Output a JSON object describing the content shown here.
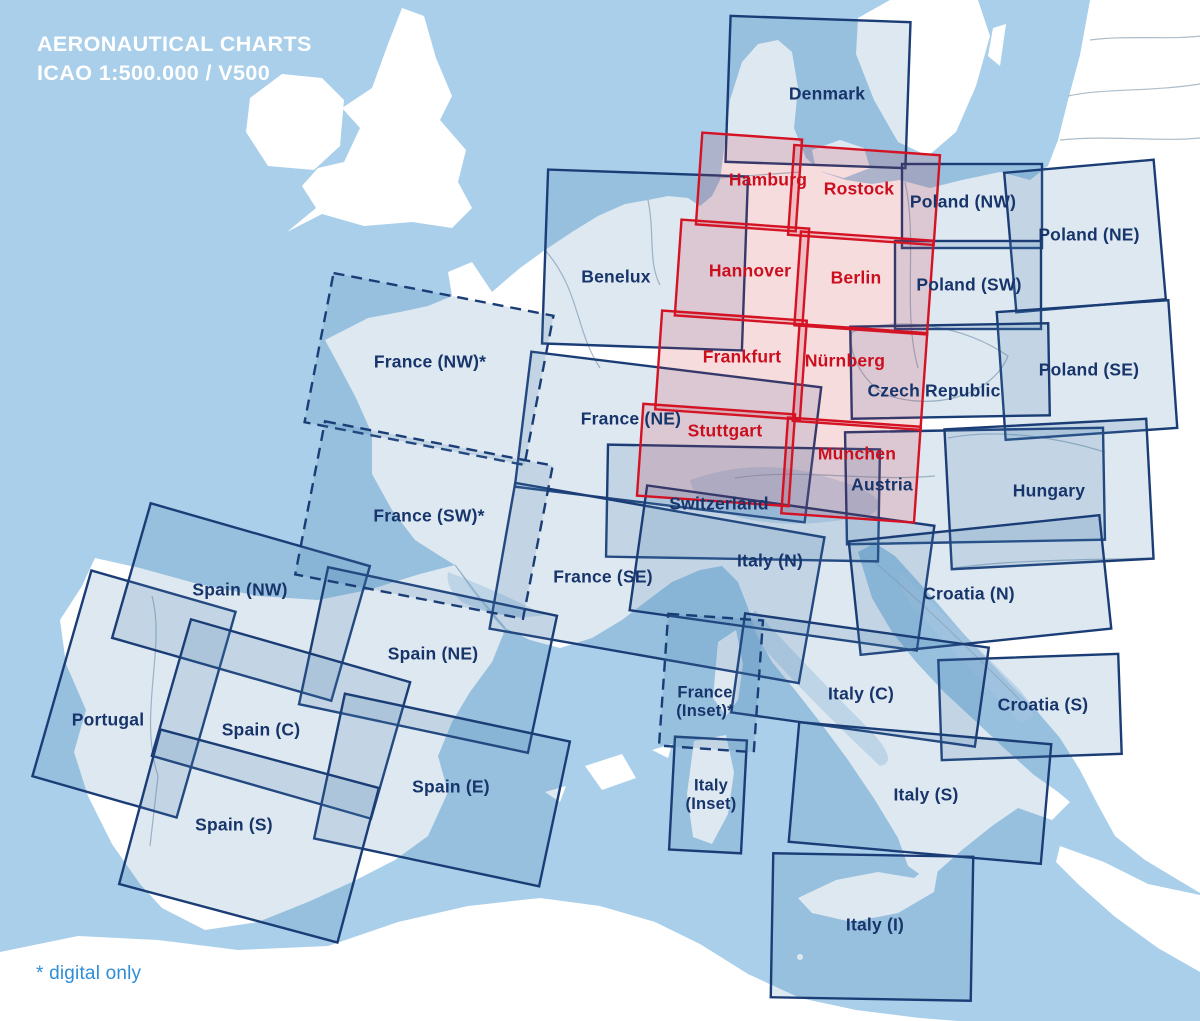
{
  "title": {
    "line1": "AERONAUTICAL CHARTS",
    "line2": "ICAO 1:500.000 / V500"
  },
  "footnote": "* digital only",
  "colors": {
    "sea": "#a9cfea",
    "land": "#ffffff",
    "country_border": "#9fb2c1",
    "international_stroke": "#1b3d76",
    "international_fill": "rgba(73,126,176,0.18)",
    "international_label": "#17356b",
    "germany_stroke": "#d41224",
    "germany_fill": "rgba(205,35,50,0.16)",
    "germany_label": "#cc0f1e",
    "title_text": "#ffffff",
    "footnote_text": "#2e8ed8"
  },
  "map": {
    "charts": [
      {
        "id": "denmark",
        "series": "international",
        "style": "solid",
        "box": {
          "cx": 818,
          "cy": 92,
          "w": 180,
          "h": 146,
          "rot": 2
        },
        "label": {
          "x": 827,
          "y": 95,
          "lines": [
            "Denmark"
          ]
        }
      },
      {
        "id": "poland-nw",
        "series": "international",
        "style": "solid",
        "box": {
          "cx": 972,
          "cy": 206,
          "w": 140,
          "h": 84,
          "rot": 0
        },
        "label": {
          "x": 963,
          "y": 203,
          "lines": [
            "Poland (NW)"
          ]
        }
      },
      {
        "id": "poland-ne",
        "series": "international",
        "style": "solid",
        "box": {
          "cx": 1085,
          "cy": 236,
          "w": 150,
          "h": 140,
          "rot": -5
        },
        "label": {
          "x": 1089,
          "y": 236,
          "lines": [
            "Poland (NE)"
          ]
        }
      },
      {
        "id": "poland-sw",
        "series": "international",
        "style": "solid",
        "box": {
          "cx": 968,
          "cy": 285,
          "w": 146,
          "h": 88,
          "rot": 0
        },
        "label": {
          "x": 969,
          "y": 286,
          "lines": [
            "Poland (SW)"
          ]
        }
      },
      {
        "id": "poland-se",
        "series": "international",
        "style": "solid",
        "box": {
          "cx": 1087,
          "cy": 370,
          "w": 172,
          "h": 128,
          "rot": -4
        },
        "label": {
          "x": 1089,
          "y": 371,
          "lines": [
            "Poland (SE)"
          ]
        }
      },
      {
        "id": "benelux",
        "series": "international",
        "style": "solid",
        "box": {
          "cx": 645,
          "cy": 260,
          "w": 200,
          "h": 174,
          "rot": 2
        },
        "label": {
          "x": 616,
          "y": 278,
          "lines": [
            "Benelux"
          ]
        }
      },
      {
        "id": "france-ne",
        "series": "international",
        "style": "solid",
        "box": {
          "cx": 668,
          "cy": 437,
          "w": 292,
          "h": 136,
          "rot": 7
        },
        "label": {
          "x": 631,
          "y": 420,
          "lines": [
            "France (NE)"
          ]
        }
      },
      {
        "id": "czech-republic",
        "series": "international",
        "style": "solid",
        "box": {
          "cx": 950,
          "cy": 371,
          "w": 198,
          "h": 92,
          "rot": -1
        },
        "label": {
          "x": 934,
          "y": 392,
          "lines": [
            "Czech Republic"
          ]
        }
      },
      {
        "id": "switzerland",
        "series": "international",
        "style": "solid",
        "box": {
          "cx": 743,
          "cy": 503,
          "w": 272,
          "h": 112,
          "rot": 1
        },
        "label": {
          "x": 719,
          "y": 505,
          "lines": [
            "Switzerland"
          ]
        }
      },
      {
        "id": "austria",
        "series": "international",
        "style": "solid",
        "box": {
          "cx": 975,
          "cy": 486,
          "w": 258,
          "h": 112,
          "rot": -1
        },
        "label": {
          "x": 882,
          "y": 486,
          "lines": [
            "Austria"
          ]
        }
      },
      {
        "id": "hungary",
        "series": "international",
        "style": "solid",
        "box": {
          "cx": 1049,
          "cy": 494,
          "w": 202,
          "h": 140,
          "rot": -3
        },
        "label": {
          "x": 1049,
          "y": 492,
          "lines": [
            "Hungary"
          ]
        }
      },
      {
        "id": "france-se",
        "series": "international",
        "style": "solid",
        "box": {
          "cx": 657,
          "cy": 583,
          "w": 314,
          "h": 148,
          "rot": 10
        },
        "label": {
          "x": 603,
          "y": 578,
          "lines": [
            "France (SE)"
          ]
        }
      },
      {
        "id": "italy-n",
        "series": "international",
        "style": "solid",
        "box": {
          "cx": 782,
          "cy": 568,
          "w": 290,
          "h": 126,
          "rot": 8
        },
        "label": {
          "x": 770,
          "y": 562,
          "lines": [
            "Italy (N)"
          ]
        }
      },
      {
        "id": "croatia-n",
        "series": "international",
        "style": "solid",
        "box": {
          "cx": 980,
          "cy": 585,
          "w": 252,
          "h": 114,
          "rot": -6
        },
        "label": {
          "x": 969,
          "y": 595,
          "lines": [
            "Croatia (N)"
          ]
        }
      },
      {
        "id": "croatia-s",
        "series": "international",
        "style": "solid",
        "box": {
          "cx": 1030,
          "cy": 707,
          "w": 180,
          "h": 100,
          "rot": -2
        },
        "label": {
          "x": 1043,
          "y": 706,
          "lines": [
            "Croatia (S)"
          ]
        }
      },
      {
        "id": "italy-c",
        "series": "international",
        "style": "solid",
        "box": {
          "cx": 860,
          "cy": 680,
          "w": 246,
          "h": 100,
          "rot": 8
        },
        "label": {
          "x": 861,
          "y": 695,
          "lines": [
            "Italy (C)"
          ]
        }
      },
      {
        "id": "italy-s",
        "series": "international",
        "style": "solid",
        "box": {
          "cx": 920,
          "cy": 793,
          "w": 253,
          "h": 120,
          "rot": 5
        },
        "label": {
          "x": 926,
          "y": 796,
          "lines": [
            "Italy (S)"
          ]
        }
      },
      {
        "id": "italy-i",
        "series": "international",
        "style": "solid",
        "box": {
          "cx": 872,
          "cy": 927,
          "w": 200,
          "h": 144,
          "rot": 1
        },
        "label": {
          "x": 875,
          "y": 926,
          "lines": [
            "Italy (I)"
          ]
        }
      },
      {
        "id": "italy-inset",
        "series": "international",
        "style": "solid",
        "box": {
          "cx": 708,
          "cy": 795,
          "w": 72,
          "h": 113,
          "rot": 3
        },
        "label": {
          "x": 711,
          "y": 786,
          "size": 16.5,
          "lines": [
            "Italy",
            "(Inset)"
          ]
        }
      },
      {
        "id": "portugal",
        "series": "international",
        "style": "solid",
        "box": {
          "cx": 134,
          "cy": 694,
          "w": 150,
          "h": 214,
          "rot": 16
        },
        "label": {
          "x": 108,
          "y": 721,
          "lines": [
            "Portugal"
          ]
        }
      },
      {
        "id": "spain-nw",
        "series": "international",
        "style": "solid",
        "box": {
          "cx": 241,
          "cy": 602,
          "w": 228,
          "h": 140,
          "rot": 16
        },
        "label": {
          "x": 240,
          "y": 591,
          "lines": [
            "Spain (NW)"
          ]
        }
      },
      {
        "id": "spain-ne",
        "series": "international",
        "style": "solid",
        "box": {
          "cx": 428,
          "cy": 660,
          "w": 234,
          "h": 140,
          "rot": 12
        },
        "label": {
          "x": 433,
          "y": 655,
          "lines": [
            "Spain (NE)"
          ]
        }
      },
      {
        "id": "spain-c",
        "series": "international",
        "style": "solid",
        "box": {
          "cx": 281,
          "cy": 719,
          "w": 228,
          "h": 142,
          "rot": 16
        },
        "label": {
          "x": 261,
          "y": 731,
          "lines": [
            "Spain (C)"
          ]
        }
      },
      {
        "id": "spain-e",
        "series": "international",
        "style": "solid",
        "box": {
          "cx": 442,
          "cy": 790,
          "w": 230,
          "h": 148,
          "rot": 12
        },
        "label": {
          "x": 451,
          "y": 788,
          "lines": [
            "Spain (E)"
          ]
        }
      },
      {
        "id": "spain-s",
        "series": "international",
        "style": "solid",
        "box": {
          "cx": 249,
          "cy": 836,
          "w": 226,
          "h": 160,
          "rot": 15
        },
        "label": {
          "x": 234,
          "y": 826,
          "lines": [
            "Spain (S)"
          ]
        }
      },
      {
        "id": "france-nw",
        "series": "international",
        "style": "dashed",
        "box": {
          "cx": 429,
          "cy": 369,
          "w": 224,
          "h": 152,
          "rot": 11
        },
        "label": {
          "x": 430,
          "y": 363,
          "lines": [
            "France (NW)*"
          ]
        }
      },
      {
        "id": "france-sw",
        "series": "international",
        "style": "dashed",
        "box": {
          "cx": 424,
          "cy": 520,
          "w": 232,
          "h": 156,
          "rot": 11
        },
        "label": {
          "x": 429,
          "y": 517,
          "lines": [
            "France (SW)*"
          ]
        }
      },
      {
        "id": "france-inset",
        "series": "international",
        "style": "dashed",
        "box": {
          "cx": 711,
          "cy": 683,
          "w": 95,
          "h": 132,
          "rot": 4
        },
        "label": {
          "x": 705,
          "y": 693,
          "size": 16.5,
          "lines": [
            "France",
            "(Inset)*"
          ]
        }
      },
      {
        "id": "hamburg",
        "series": "germany",
        "style": "solid",
        "box": {
          "cx": 749,
          "cy": 182,
          "w": 100,
          "h": 92,
          "rot": 4
        },
        "label": {
          "x": 768,
          "y": 181,
          "lines": [
            "Hamburg"
          ]
        }
      },
      {
        "id": "rostock",
        "series": "germany",
        "style": "solid",
        "box": {
          "cx": 864,
          "cy": 195,
          "w": 146,
          "h": 90,
          "rot": 4
        },
        "label": {
          "x": 859,
          "y": 190,
          "lines": [
            "Rostock"
          ]
        }
      },
      {
        "id": "hannover",
        "series": "germany",
        "style": "solid",
        "box": {
          "cx": 742,
          "cy": 272,
          "w": 128,
          "h": 96,
          "rot": 4
        },
        "label": {
          "x": 750,
          "y": 272,
          "lines": [
            "Hannover"
          ]
        }
      },
      {
        "id": "berlin",
        "series": "germany",
        "style": "solid",
        "box": {
          "cx": 864,
          "cy": 283,
          "w": 133,
          "h": 94,
          "rot": 4
        },
        "label": {
          "x": 856,
          "y": 279,
          "lines": [
            "Berlin"
          ]
        }
      },
      {
        "id": "frankfurt",
        "series": "germany",
        "style": "solid",
        "box": {
          "cx": 731,
          "cy": 365,
          "w": 145,
          "h": 99,
          "rot": 4
        },
        "label": {
          "x": 742,
          "y": 358,
          "lines": [
            "Frankfurt"
          ]
        }
      },
      {
        "id": "nuernberg",
        "series": "germany",
        "style": "solid",
        "box": {
          "cx": 860,
          "cy": 377,
          "w": 128,
          "h": 97,
          "rot": 4
        },
        "label": {
          "x": 845,
          "y": 362,
          "lines": [
            "Nürnberg"
          ]
        }
      },
      {
        "id": "stuttgart",
        "series": "germany",
        "style": "solid",
        "box": {
          "cx": 716,
          "cy": 455,
          "w": 152,
          "h": 92,
          "rot": 4
        },
        "label": {
          "x": 725,
          "y": 432,
          "lines": [
            "Stuttgart"
          ]
        }
      },
      {
        "id": "muenchen",
        "series": "germany",
        "style": "solid",
        "box": {
          "cx": 851,
          "cy": 470,
          "w": 133,
          "h": 96,
          "rot": 4
        },
        "label": {
          "x": 857,
          "y": 455,
          "lines": [
            "München"
          ]
        }
      }
    ]
  }
}
